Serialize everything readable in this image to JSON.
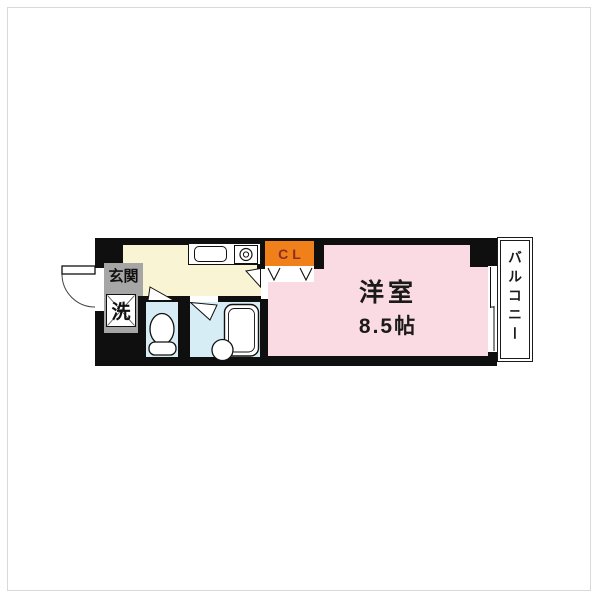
{
  "floor_plan": {
    "type": "apartment-1K-floor-plan",
    "rooms": {
      "entrance": {
        "label": "玄関"
      },
      "laundry": {
        "label": "洗"
      },
      "closet": {
        "label": "CL"
      },
      "main_room": {
        "name": "洋室",
        "size": "8.5帖"
      },
      "balcony": {
        "label": "バルコニー"
      },
      "kitchen": {
        "label": ""
      },
      "toilet": {
        "label": ""
      },
      "bathroom": {
        "label": ""
      }
    },
    "colors": {
      "wall": "#0f0f0f",
      "kitchen_floor": "#f8f4d4",
      "main_room_floor": "#fadbe3",
      "wet_area_floor": "#d6edf6",
      "entrance_floor": "#a6a6a6",
      "closet_background": "#f08019",
      "closet_text": "#8c2f22",
      "background": "#ffffff",
      "frame_border": "#d9d9d9"
    },
    "fixtures": [
      "entrance-door-swing-icon",
      "washing-machine-icon",
      "kitchen-sink-icon",
      "gas-stove-icon",
      "toilet-icon",
      "bathtub-icon",
      "wash-basin-icon",
      "closet-bifold-door-icon",
      "sliding-window-icon",
      "room-door-swing-icon",
      "toilet-door-swing-icon",
      "bath-door-icon"
    ]
  }
}
